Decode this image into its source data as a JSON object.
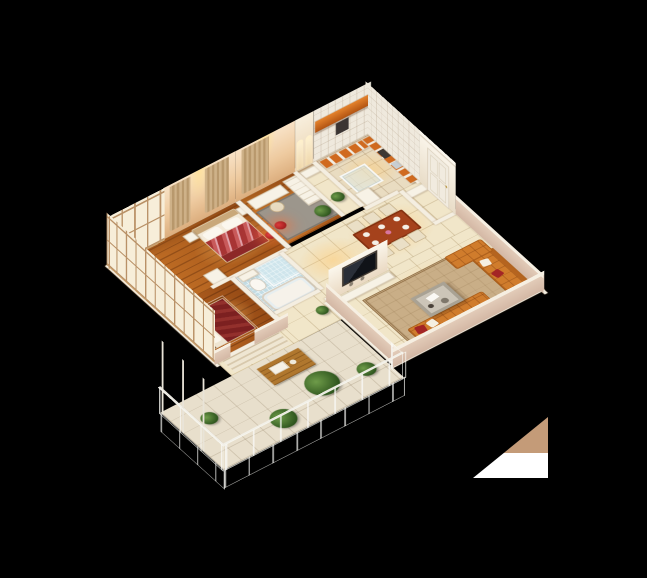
{
  "scene": {
    "description": "3D isometric cutaway rendering of a furnished three-room apartment floor plan, viewed from above at an angle, on a solid black background",
    "view": "isometric bird's-eye cutaway",
    "background_color": "#000000"
  },
  "palette": {
    "wood_floor": "#b2601d",
    "cream_tile_floor": "#f1e6c9",
    "kitchen_tile_floor": "#e9dcc1",
    "bath_mosaic_blue": "#c3dde5",
    "wall_peach": "#eeca9f",
    "wall_white": "#f4eee1",
    "sofa_orange": "#d07c2c",
    "bedding_red": "#a83434",
    "bedding_dark_red": "#7c2020",
    "counter_orange": "#c55a17",
    "lamp_red": "#b61d1d",
    "rug_tan": "#c9ae87",
    "plant_green": "#30571f",
    "glass_railing": "#d7e4e8"
  },
  "rooms": {
    "master_bedroom": {
      "name": "Master bedroom",
      "furniture": [
        "double bed with red striped bedding",
        "white pillows",
        "two nightstands",
        "red shaded floor lamp",
        "wall curtains",
        "dresser",
        "bay window with dried plants"
      ]
    },
    "second_bedroom": {
      "name": "Second bedroom",
      "furniture": [
        "double bed with dark red bedding",
        "canopy frame",
        "west window wall",
        "nightstand"
      ]
    },
    "study": {
      "name": "Study",
      "furniture": [
        "desk",
        "chair",
        "white bookshelf",
        "red drum floor lamp",
        "potted plant",
        "gray rug"
      ]
    },
    "kitchen": {
      "name": "Kitchen",
      "furniture": [
        "orange upper cabinet bar",
        "white base cabinets with orange fronts",
        "sink",
        "stove",
        "glass display cabinet",
        "refrigerator"
      ]
    },
    "bathroom": {
      "name": "Bathroom",
      "furniture": [
        "glass shower enclosure",
        "bathtub",
        "toilet",
        "sink counter",
        "blue mosaic floor"
      ]
    },
    "dining_room": {
      "name": "Dining area",
      "furniture": [
        "red-brown dining table",
        "six cream upholstered chairs",
        "table setting with plates and flowers",
        "ceiling light pool"
      ]
    },
    "living_room": {
      "name": "Living room",
      "furniture": [
        "orange tufted sectional sofa",
        "orange chaise ottoman",
        "red and white throw pillows",
        "two-tier coffee table",
        "patterned tan area rug",
        "TV on white partition wall",
        "media console",
        "floor plant"
      ]
    },
    "entry": {
      "name": "Entrance hall",
      "furniture": [
        "white paneled entry door with crown molding",
        "shoe cabinet"
      ]
    },
    "hallway": {
      "name": "Hallway",
      "furniture": [
        "arched wall niches",
        "console table",
        "potted plant",
        "steps to balcony"
      ]
    },
    "balcony": {
      "name": "Balcony",
      "furniture": [
        "glass and metal railing with tall frame posts",
        "palm plant",
        "monstera plant",
        "small potted plants",
        "wooden deck table with tray"
      ]
    }
  },
  "artifact": {
    "description": "small two-tone triangle shape at lower right of image",
    "tan_color": "#c49b78",
    "white_color": "#ffffff"
  }
}
